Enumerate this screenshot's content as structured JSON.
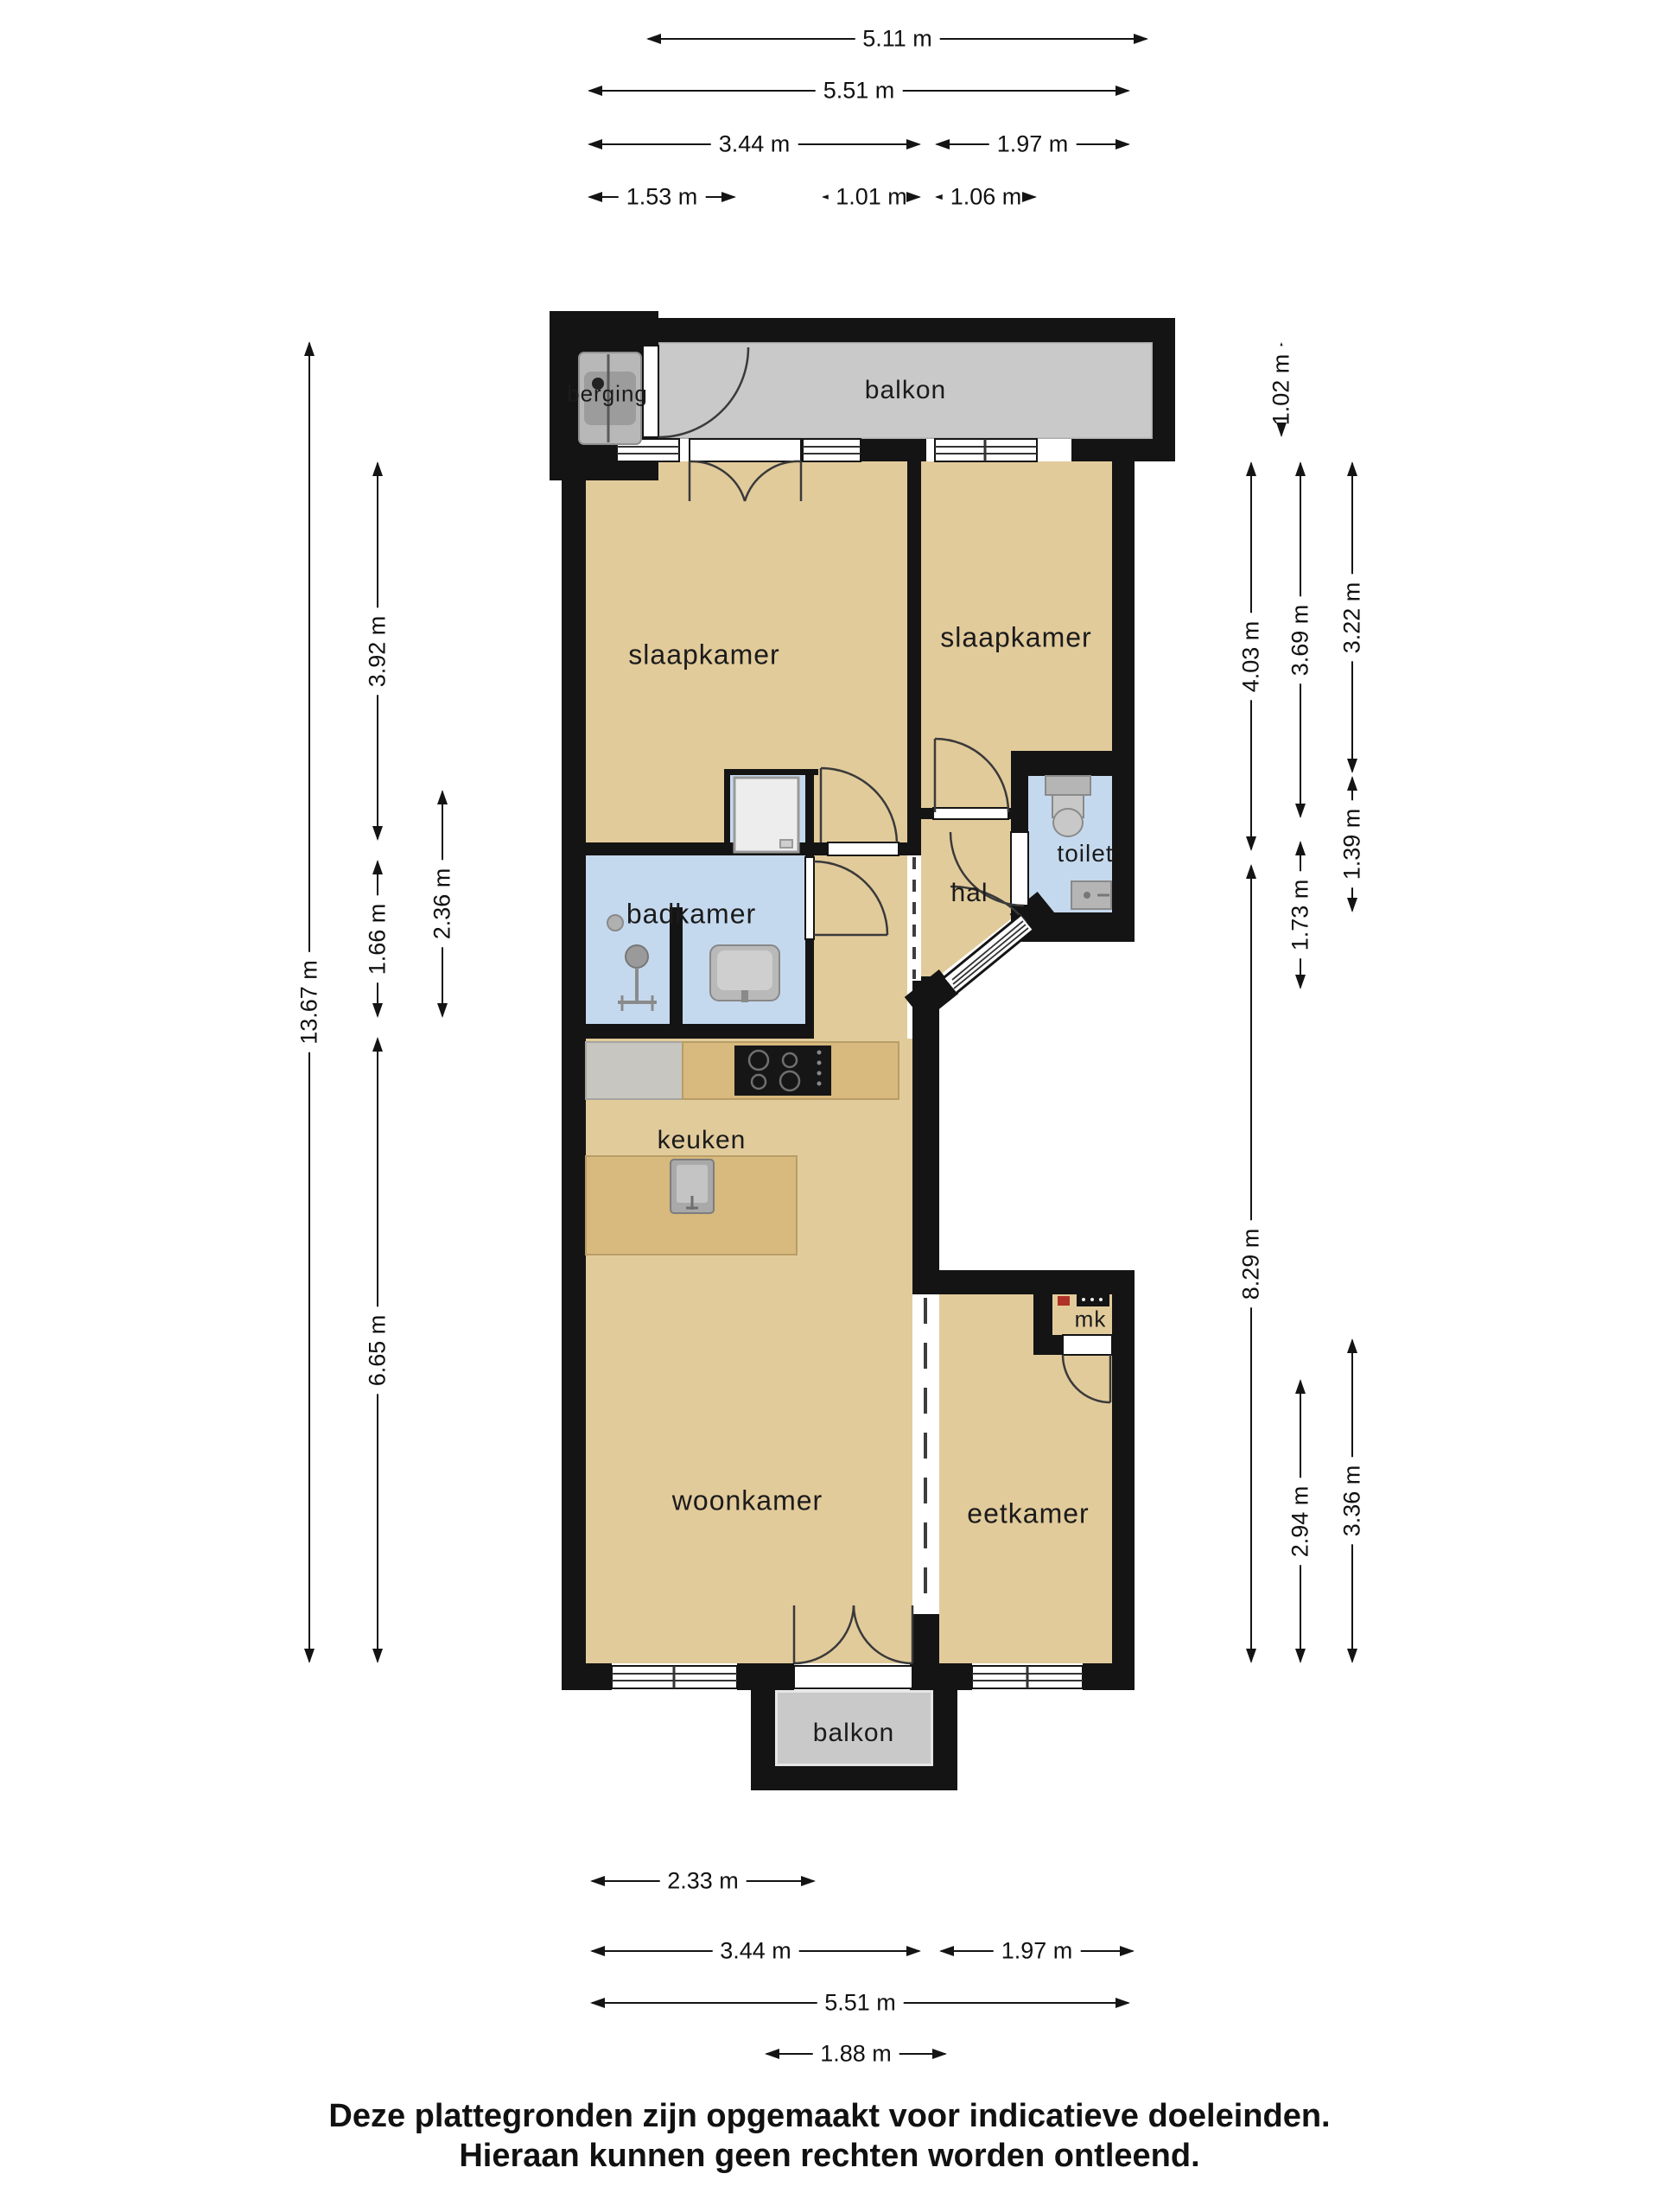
{
  "rooms": {
    "berging": "berging",
    "balkon_top": "balkon",
    "slaapkamer_left": "slaapkamer",
    "slaapkamer_right": "slaapkamer",
    "badkamer": "badkamer",
    "hal": "hal",
    "toilet": "toilet",
    "keuken": "keuken",
    "woonkamer": "woonkamer",
    "eetkamer": "eetkamer",
    "meterkast": "mk",
    "balkon_bottom": "balkon"
  },
  "dimensions": {
    "top": [
      {
        "label": "5.11 m"
      },
      {
        "label": "5.51 m"
      },
      {
        "label": "3.44 m"
      },
      {
        "label": "1.97 m"
      },
      {
        "label": "1.53 m"
      },
      {
        "label": "1.01 m"
      },
      {
        "label": "1.06 m"
      }
    ],
    "bottom": [
      {
        "label": "2.33 m"
      },
      {
        "label": "3.44 m"
      },
      {
        "label": "1.97 m"
      },
      {
        "label": "5.51 m"
      },
      {
        "label": "1.88 m"
      }
    ],
    "left": [
      {
        "label": "13.67 m"
      },
      {
        "label": "3.92 m"
      },
      {
        "label": "1.66 m"
      },
      {
        "label": "2.36 m"
      },
      {
        "label": "6.65 m"
      }
    ],
    "right": [
      {
        "label": "1.02 m"
      },
      {
        "label": "4.03 m"
      },
      {
        "label": "3.69 m"
      },
      {
        "label": "3.22 m"
      },
      {
        "label": "1.39 m"
      },
      {
        "label": "1.73 m"
      },
      {
        "label": "8.29 m"
      },
      {
        "label": "2.94 m"
      },
      {
        "label": "3.36 m"
      }
    ]
  },
  "disclaimer": {
    "line1": "Deze plattegronden zijn opgemaakt voor indicatieve doeleinden.",
    "line2": "Hieraan kunnen geen rechten worden ontleend."
  },
  "colors": {
    "wall": "#141414",
    "floor_beige": "#e2cb9b",
    "wet_room_blue": "#c5d9ee",
    "balcony_gray": "#c9c9c9",
    "storage_gray": "#d9d9d9",
    "counter_wood": "#d8b97e",
    "counter_gray": "#c8c6c1",
    "fixture_gray": "#b5b5b5"
  },
  "icons": {
    "washing-machine-icon": "rounded-rect-with-dot",
    "shower-icon": "circle-with-arm",
    "drain-icon": "small-circle",
    "shower-cabin-icon": "light-rect",
    "bath-sink-icon": "rounded-rect-basin",
    "toilet-icon": "tank-and-bowl",
    "toilet-sink-icon": "small-basin",
    "cooktop-icon": "black-rect-4-burners",
    "island-sink-icon": "square-basin-with-faucet",
    "meter-cabinet-icon": "red-and-black-meters"
  }
}
